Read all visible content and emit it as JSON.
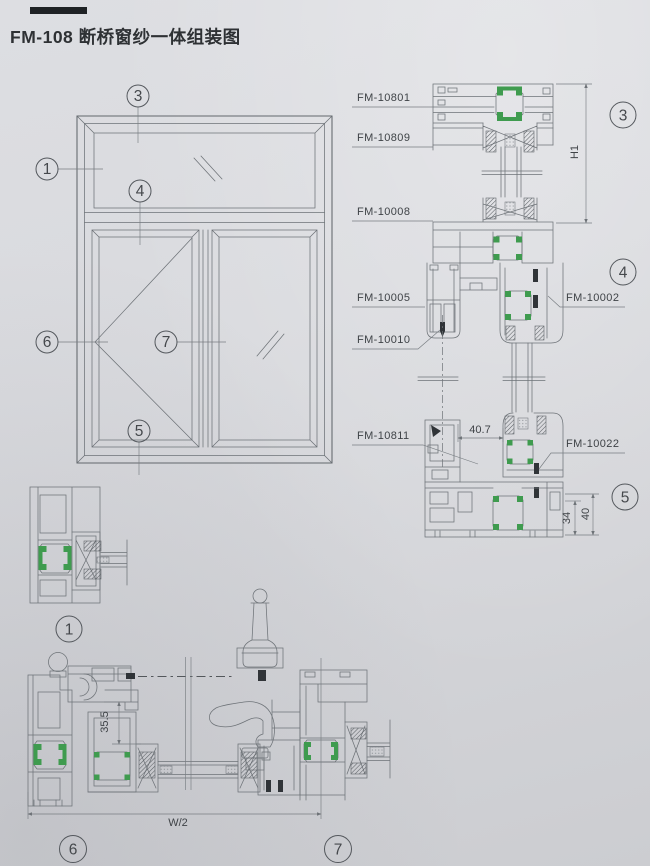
{
  "title": "FM-108 断桥窗纱一体组装图",
  "colors": {
    "bg": "#d6d7db",
    "line": "#6e7378",
    "green": "#3f9b4f",
    "ink": "#3f4347",
    "title": "#2e3134",
    "dark": "#303438"
  },
  "callouts": {
    "n1": "1",
    "n3": "3",
    "n4": "4",
    "n5": "5",
    "n6": "6",
    "n7": "7"
  },
  "parts": {
    "fm10801": "FM-10801",
    "fm10809": "FM-10809",
    "fm10008": "FM-10008",
    "fm10005": "FM-10005",
    "fm10010": "FM-10010",
    "fm10002": "FM-10002",
    "fm10811": "FM-10811",
    "fm10022": "FM-10022"
  },
  "dims": {
    "h1": "H1",
    "d40_7": "40.7",
    "d34": "34",
    "d40": "40",
    "d35_5": "35.5",
    "w_half": "W/2"
  }
}
